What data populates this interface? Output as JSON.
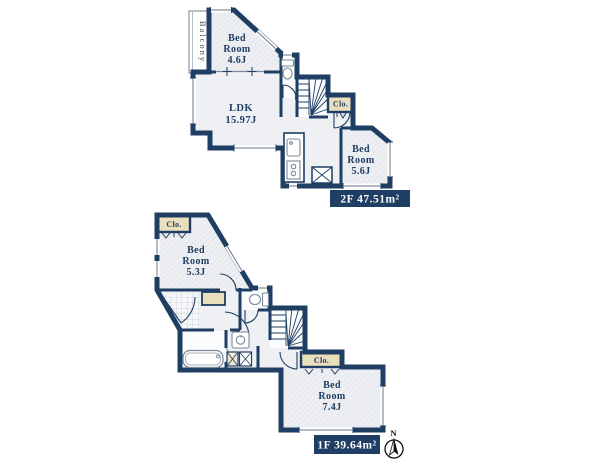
{
  "f2": {
    "bedroom_a": [
      "Bed",
      "Room",
      "4.6J"
    ],
    "ldk": [
      "LDK",
      "15.97J"
    ],
    "bedroom_b": [
      "Bed",
      "Room",
      "5.6J"
    ],
    "closet": "Clo.",
    "balcony": "Balcony",
    "area_label": "2F 47.51m²"
  },
  "f1": {
    "bedroom_a": [
      "Bed",
      "Room",
      "5.3J"
    ],
    "bedroom_b": [
      "Bed",
      "Room",
      "7.4J"
    ],
    "closet_a": "Clo.",
    "closet_b": "Clo.",
    "area_label": "1F 39.64m²"
  },
  "compass": {
    "north": "N"
  },
  "colors": {
    "wall_navy": "#1f3e63",
    "floor_fill": "#eef0f3",
    "hatch_line": "#d9dce2",
    "closet_beige": "#eadfbc",
    "label_bg": "#1f3e63",
    "label_text": "#ffffff",
    "background": "#ffffff"
  }
}
